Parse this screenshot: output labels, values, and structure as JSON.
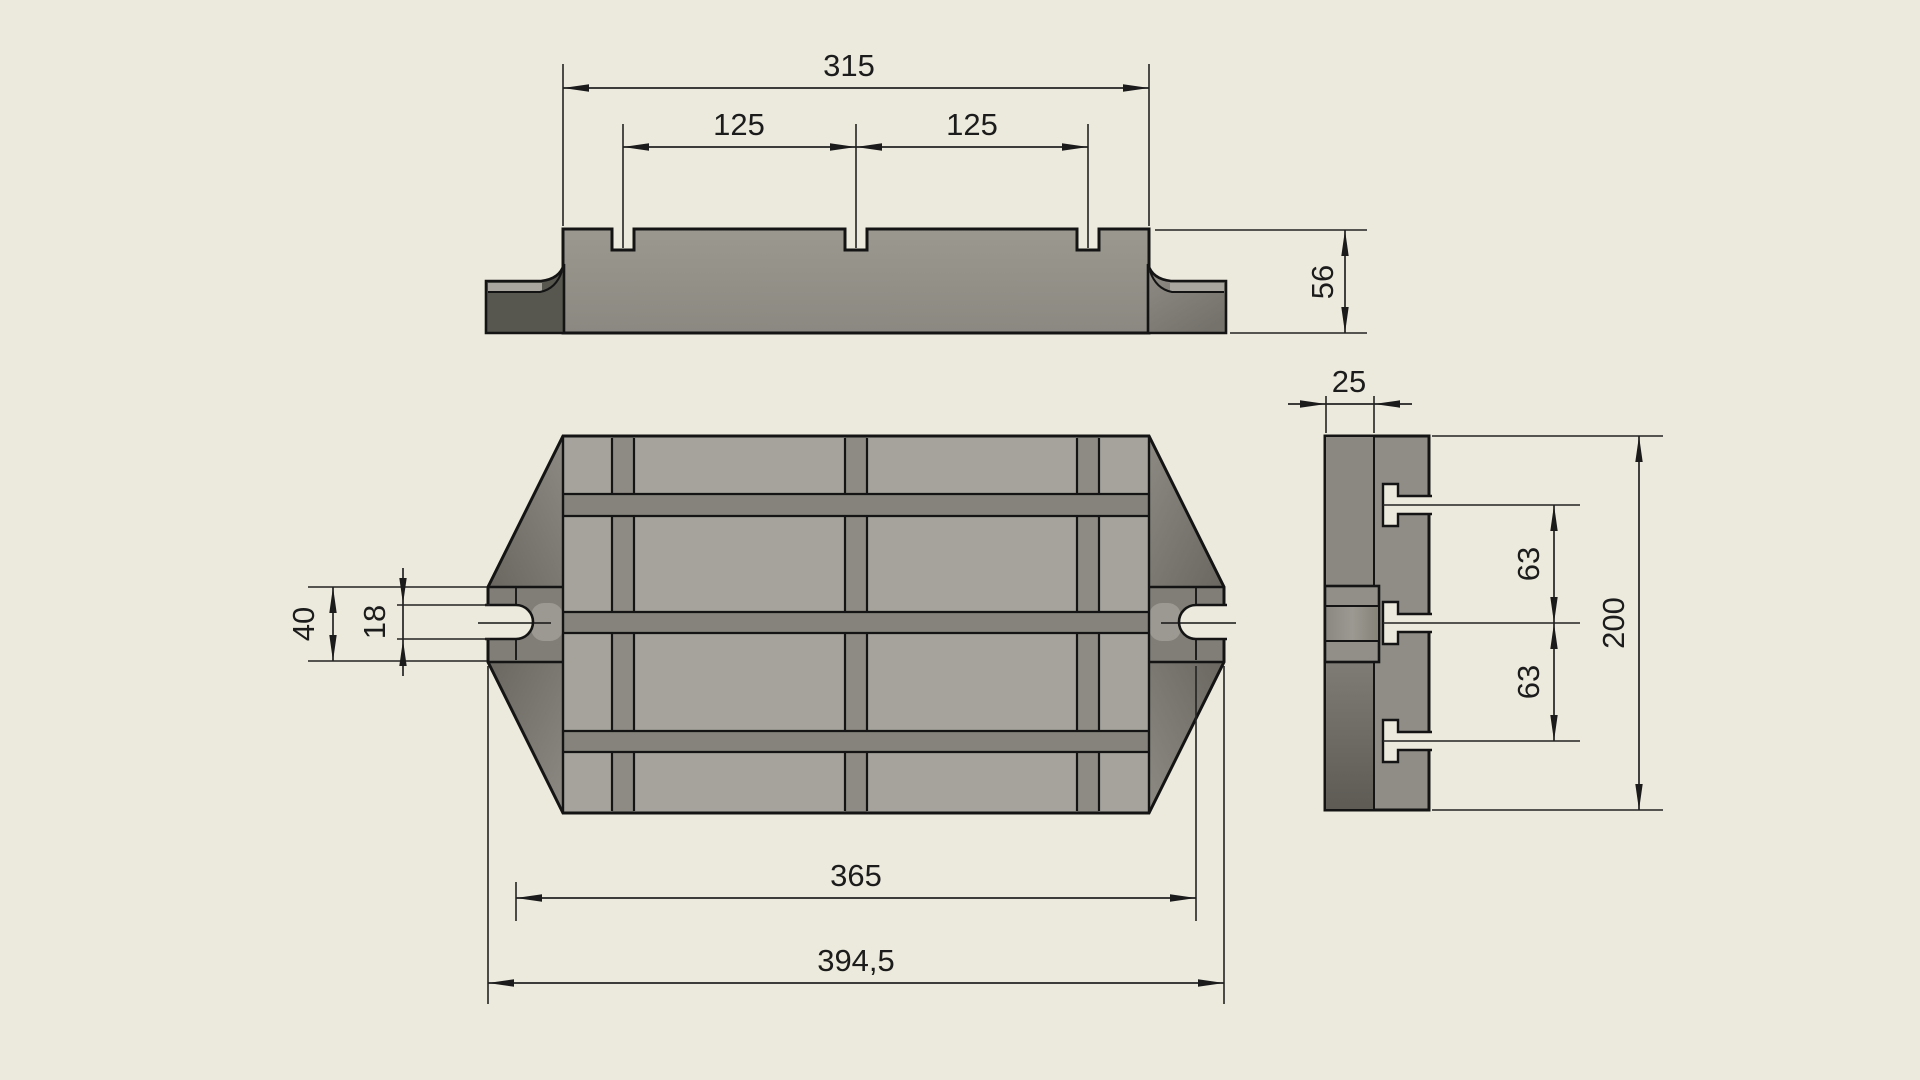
{
  "front_view": {
    "dim_width": "315",
    "dim_pitch_left": "125",
    "dim_pitch_right": "125",
    "dim_height": "56"
  },
  "plan_view": {
    "dim_tab_width": "40",
    "dim_slot_opening": "18",
    "dim_slot_centers": "365",
    "dim_overall_length": "394,5"
  },
  "side_view": {
    "dim_lip_height": "25",
    "dim_tslot_pitch_upper": "63",
    "dim_tslot_pitch_lower": "63",
    "dim_overall_width": "200"
  },
  "colors": {
    "background": "#ECEADD",
    "outline": "#141414",
    "face_light": "#A5A39B",
    "band_dark": "#85837B",
    "chamfer_dark": "#6B6962",
    "lip_dark": "#57564F"
  }
}
